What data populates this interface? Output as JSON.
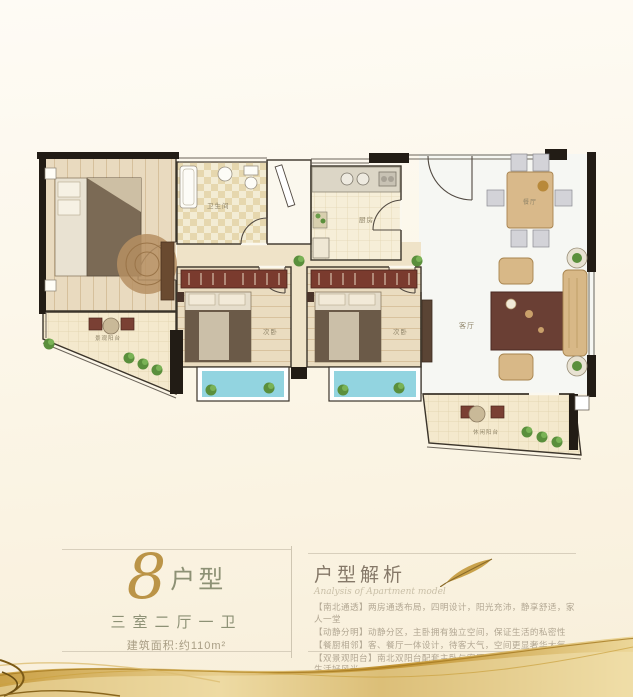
{
  "floorplan": {
    "labels": {
      "bathroom": "卫生间",
      "kitchen": "厨房",
      "dining": "餐厅",
      "living": "客厅",
      "bedroom_a": "次卧",
      "bedroom_b": "次卧",
      "balcony_left": "景观阳台",
      "balcony_right": "休闲阳台"
    }
  },
  "unit_info": {
    "number": "8",
    "suffix": "户型",
    "layout": "三室二厅一卫",
    "area": "建筑面积:约110m²"
  },
  "analysis": {
    "title": "户型解析",
    "subtitle": "Analysis of Apartment model",
    "lines": [
      "【南北通透】两房通透布局，四明设计，阳光充沛，静享舒适，家人一堂",
      "【动静分明】动静分区，主卧拥有独立空间，保证生活的私密性",
      "【餐厨相邻】客、餐厅一体设计，待客大气，空间更显奢华大气",
      "【双景观阳台】南北双阳台配套主卧与客厅，视野通达致远，悦享生活好风光"
    ]
  },
  "colors": {
    "accent_gold": "#c9a24b",
    "wall_black": "#221c15",
    "bay_window_blue": "#92d4e0",
    "label_grey": "#8f8468",
    "text_olive": "#8d9175"
  }
}
